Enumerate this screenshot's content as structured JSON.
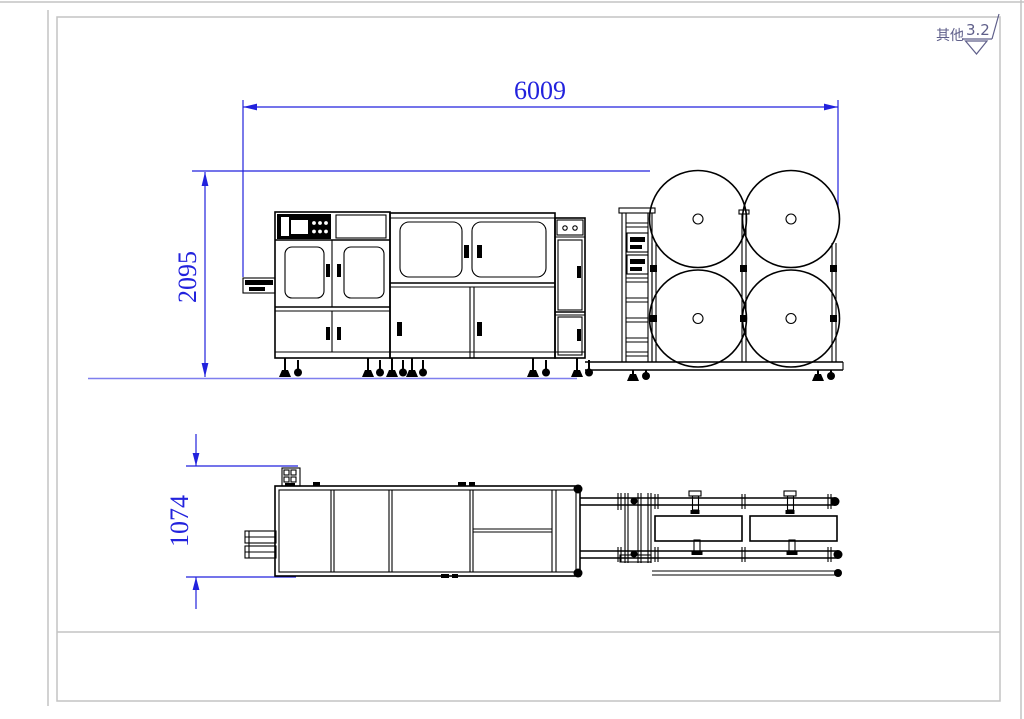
{
  "annotations": {
    "surface_finish": {
      "prefix_label": "其他",
      "roughness_value": "3.2"
    }
  },
  "dimensions": {
    "overall_length": "6009",
    "overall_height": "2095",
    "overall_width": "1074"
  },
  "colors": {
    "dimension_blue": "#2222dd",
    "ground_blue": "#7f7fee",
    "line_black": "#000000",
    "frame_gray": "#c3c3c3",
    "note_navy": "#5f5f8a",
    "paper_white": "#ffffff"
  }
}
